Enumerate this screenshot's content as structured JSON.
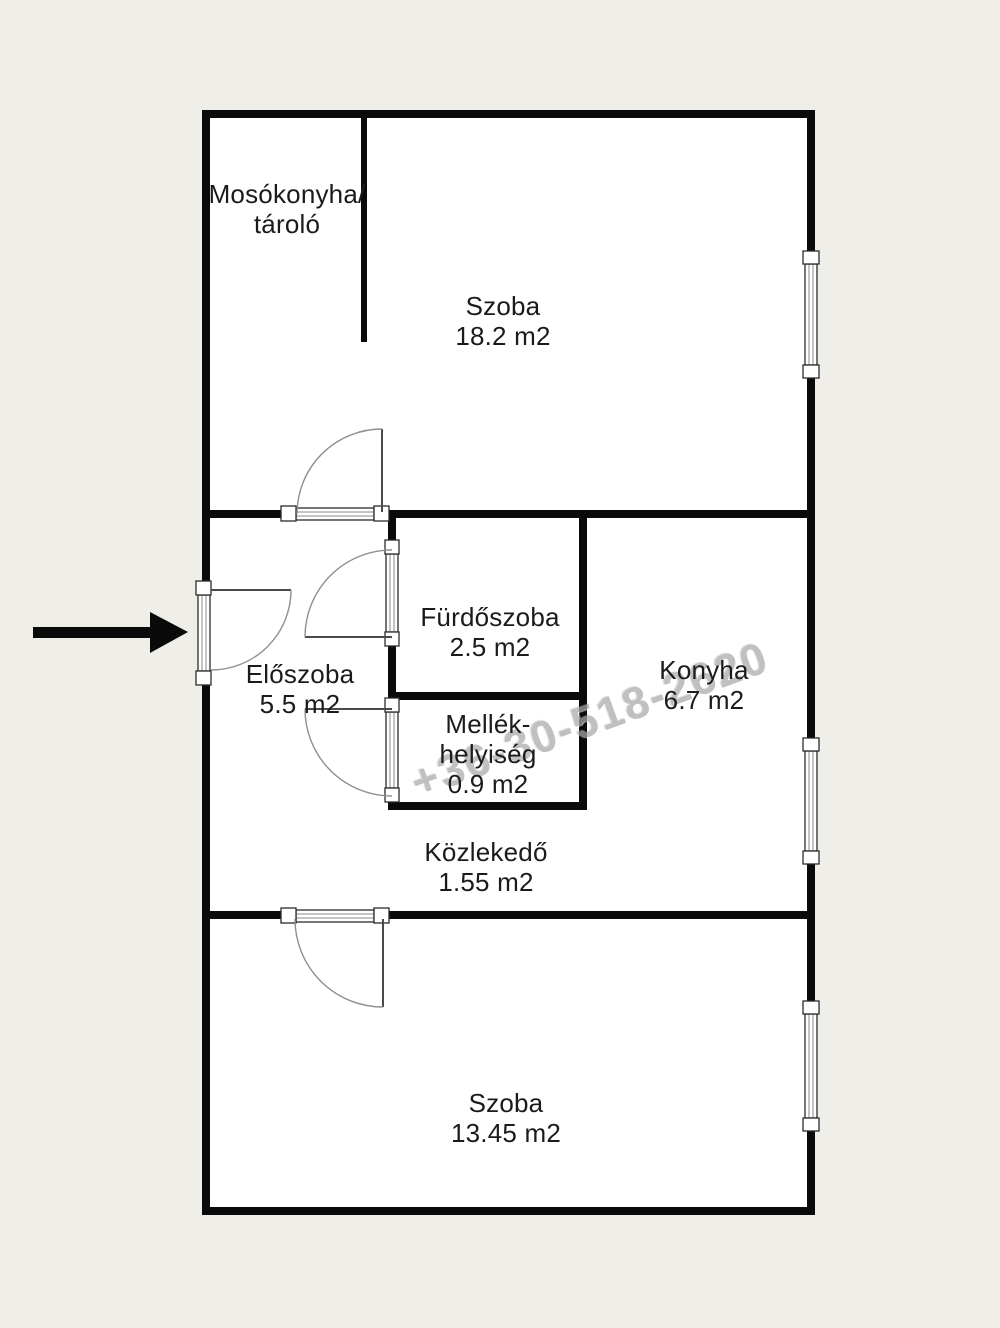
{
  "page": {
    "background": "#f0eee8"
  },
  "floor_plan": {
    "colors": {
      "floor": "#ffffff",
      "wall": "#000000",
      "label_text": "#1b1b1b",
      "watermark": "#a8a8a8"
    },
    "rooms": [
      {
        "id": "mosokonyha-tarolo",
        "lines": [
          "Mosókonyha/",
          "tároló"
        ]
      },
      {
        "id": "szoba-felso",
        "lines": [
          "Szoba",
          "18.2 m2"
        ]
      },
      {
        "id": "furdoszoba",
        "lines": [
          "Fürdőszoba",
          "2.5 m2"
        ]
      },
      {
        "id": "konyha",
        "lines": [
          "Konyha",
          "6.7 m2"
        ]
      },
      {
        "id": "eloszoba",
        "lines": [
          "Előszoba",
          "5.5 m2"
        ]
      },
      {
        "id": "mellekhelyiseg",
        "lines": [
          "Mellék-",
          "helyiség",
          "0.9 m2"
        ]
      },
      {
        "id": "kozlekedo",
        "lines": [
          "Közlekedő",
          "1.55 m2"
        ]
      },
      {
        "id": "szoba-also",
        "lines": [
          "Szoba",
          "13.45 m2"
        ]
      }
    ],
    "watermark": {
      "text": "+36-30-518-2620"
    },
    "entrance_arrow": {
      "direction": "right"
    }
  }
}
